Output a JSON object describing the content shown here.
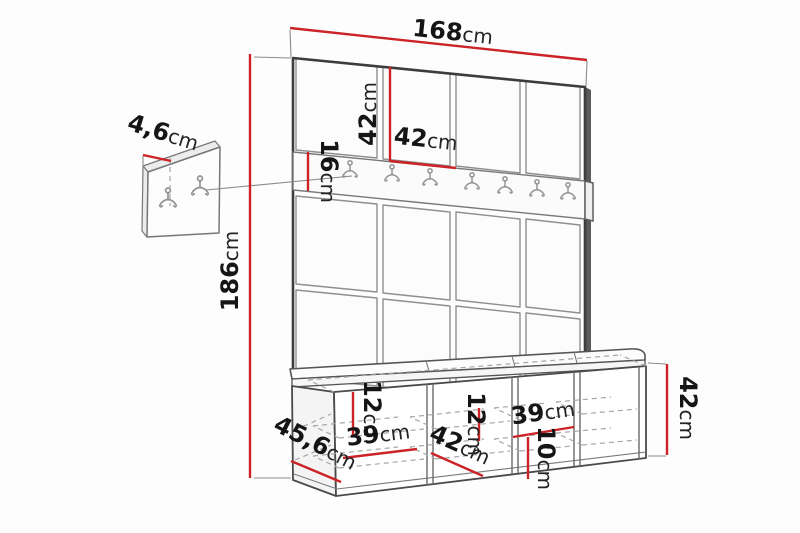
{
  "diagram": {
    "type": "furniture-dimension-drawing",
    "subject": "hallway set: upholstered wall panels, coat hook rail, wall hook panel and shoe bench",
    "accent_color": "#cc2327",
    "line_color": "#4a4a4a",
    "background": "#fdfdfd",
    "rail_hook_count": 7,
    "wall_panel_hook_count": 2,
    "dims": {
      "total_width": {
        "value": "168",
        "unit": "cm"
      },
      "square_height": {
        "value": "42",
        "unit": "cm"
      },
      "square_width": {
        "value": "42",
        "unit": "cm"
      },
      "rail_height": {
        "value": "16",
        "unit": "cm"
      },
      "total_height": {
        "value": "186",
        "unit": "cm"
      },
      "hook_panel_depth": {
        "value": "4,6",
        "unit": "cm"
      },
      "shelf_gap_left": {
        "value": "12",
        "unit": "cm"
      },
      "compartment_width_left": {
        "value": "39",
        "unit": "cm"
      },
      "bench_clear_depth": {
        "value": "42",
        "unit": "cm"
      },
      "shelf_gap_middle": {
        "value": "12",
        "unit": "cm"
      },
      "compartment_width_right": {
        "value": "39",
        "unit": "cm"
      },
      "shelf_gap_bottom": {
        "value": "10",
        "unit": "cm"
      },
      "bench_height": {
        "value": "42",
        "unit": "cm"
      },
      "bench_depth": {
        "value": "45,6",
        "unit": "cm"
      }
    }
  }
}
